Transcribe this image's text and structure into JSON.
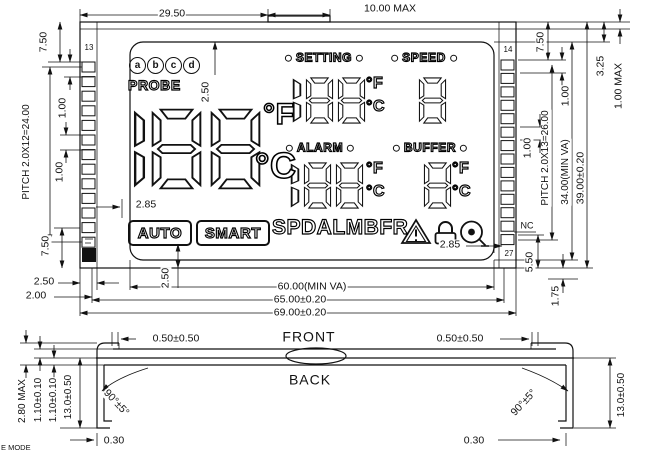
{
  "top_view": {
    "pins": {
      "left_top_pin": "13",
      "right_top_pin": "14",
      "right_bottom_pin": "27",
      "nc_label": "NC"
    },
    "display": {
      "probe_buttons": [
        "a",
        "b",
        "c",
        "d"
      ],
      "probe_label": "PROBE",
      "main_value": "188",
      "deg_f": "°F",
      "deg_c": "°C",
      "sections": [
        {
          "label": "SETTING",
          "value": "188",
          "units": [
            "°F",
            "°C"
          ]
        },
        {
          "label": "SPEED",
          "value": "8",
          "units": []
        },
        {
          "label": "ALARM",
          "value": "188",
          "units": [
            "°F",
            "°C"
          ]
        },
        {
          "label": "BUFFER",
          "value": "8",
          "units": [
            "°F",
            "°C"
          ]
        }
      ],
      "mode_badges": [
        "AUTO",
        "SMART"
      ],
      "indicator_letters": "SPDALMBFR",
      "icons": [
        "warning-triangle-icon",
        "lock-icon",
        "alarm-bell-icon"
      ]
    },
    "dimensions": {
      "top_width": "29.50",
      "tab_width": "10.00 MAX",
      "left_top_margin": "7.50",
      "left_pin_gap_upper": "1.00",
      "left_pitch": "PITCH 2.0X12=24.00",
      "left_pin_gap_lower": "1.00",
      "left_bottom_margin": "7.50",
      "ledge_width": "2.50",
      "edge_offset": "2.00",
      "va_width": "60.00(MIN VA)",
      "outline_width": "65.00±0.20",
      "total_width": "69.00±0.20",
      "right_top_margin": "7.50",
      "right_pin_gap_upper": "1.00",
      "right_pitch": "PITCH 2.0X13=26.00",
      "right_pin_gap_lower": "1.00",
      "va_height": "34.00(MIN VA)",
      "total_height": "39.00±0.20",
      "tab_height": "3.25",
      "glass_step": "1.00 MAX",
      "right_bottom_margin": "5.50",
      "bottom_edge_offset": "1.75",
      "icon_top_gap": "2.50",
      "badge_left_gap": "2.85",
      "badge_bottom_gap": "2.50",
      "icon_right_gap": "2.85"
    }
  },
  "side_view": {
    "front_label": "FRONT",
    "back_label": "BACK",
    "dimensions": {
      "left_edge_gap": "0.50±0.50",
      "right_edge_gap": "0.50±0.50",
      "total_thickness": "2.80 MAX",
      "glass_thickness_1": "1.10±0.10",
      "glass_thickness_2": "1.10±0.10",
      "pin_length_left": "13.0±0.50",
      "pin_length_right": "13.0±0.50",
      "bend_angle_left": "90°±5°",
      "bend_angle_right": "90°±5°",
      "foot_left": "0.30",
      "foot_right": "0.30"
    }
  },
  "corner_note": "E MODE"
}
